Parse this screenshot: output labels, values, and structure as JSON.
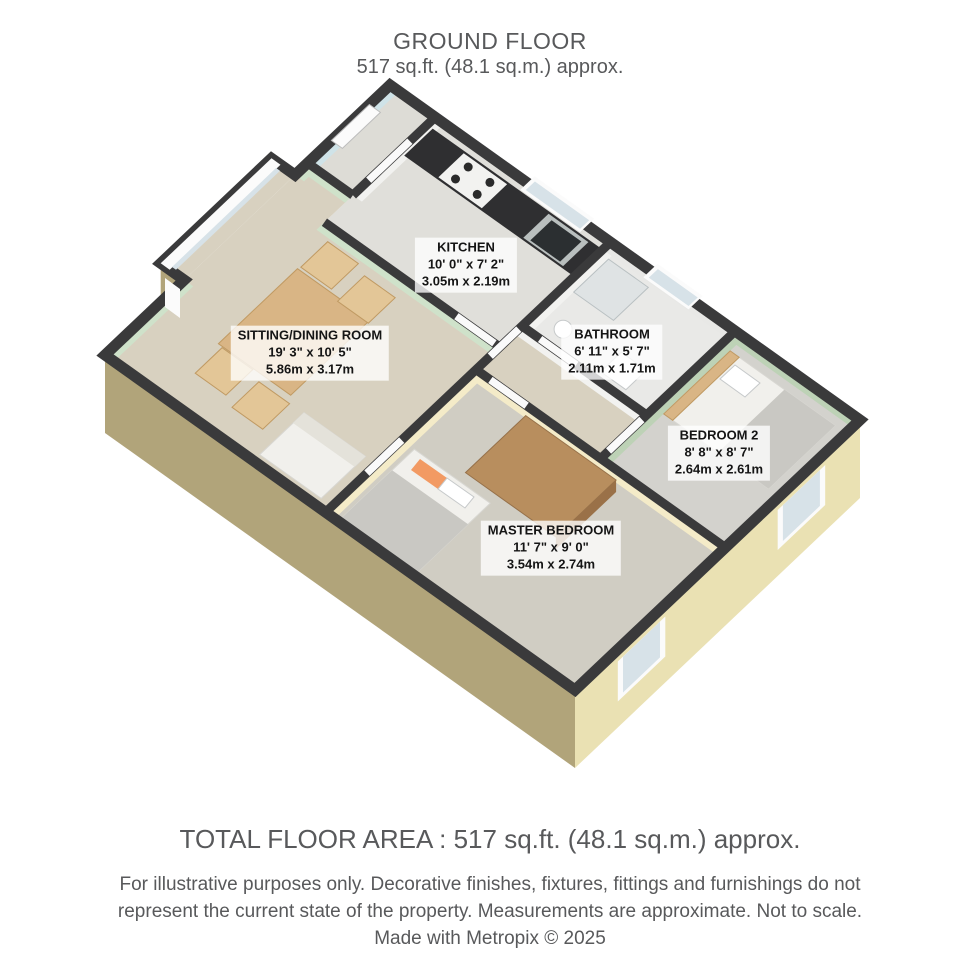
{
  "title": {
    "line1": "GROUND FLOOR",
    "line2": "517 sq.ft. (48.1 sq.m.) approx."
  },
  "rooms": [
    {
      "name": "KITCHEN",
      "imperial": "10' 0\" x 7' 2\"",
      "metric": "3.05m x 2.19m",
      "label_x": 466,
      "label_y": 265
    },
    {
      "name": "SITTING/DINING ROOM",
      "imperial": "19' 3\" x 10' 5\"",
      "metric": "5.86m x 3.17m",
      "label_x": 310,
      "label_y": 353
    },
    {
      "name": "BATHROOM",
      "imperial": "6' 11\" x 5' 7\"",
      "metric": "2.11m x 1.71m",
      "label_x": 612,
      "label_y": 352
    },
    {
      "name": "BEDROOM 2",
      "imperial": "8' 8\" x 8' 7\"",
      "metric": "2.64m x 2.61m",
      "label_x": 719,
      "label_y": 453
    },
    {
      "name": "MASTER BEDROOM",
      "imperial": "11' 7\" x 9' 0\"",
      "metric": "3.54m x 2.74m",
      "label_x": 551,
      "label_y": 548
    }
  ],
  "footer": {
    "total": "TOTAL FLOOR AREA : 517 sq.ft. (48.1 sq.m.) approx.",
    "disclaimer_line1": "For illustrative purposes only. Decorative finishes, fixtures, fittings and furnishings do not",
    "disclaimer_line2": "represent the current state of the property. Measurements are approximate. Not to scale.",
    "credit": "Made with Metropix © 2025"
  },
  "colors": {
    "wall_dark": "#3a3a3b",
    "exterior_left": "#b1a47a",
    "exterior_right": "#eae1b3",
    "wall_green": "#cfe2ca",
    "wall_green_dark": "#bdd2b6",
    "wall_cream": "#f4ebc8",
    "wall_cyan": "#cfe3e8",
    "carpet_beige": "#d8d1c0",
    "carpet_gray": "#d3d2cd",
    "wood": "#d9b585",
    "counter_dark": "#2f2f31",
    "accent_orange": "#f29a63",
    "text_gray": "#58595b"
  }
}
